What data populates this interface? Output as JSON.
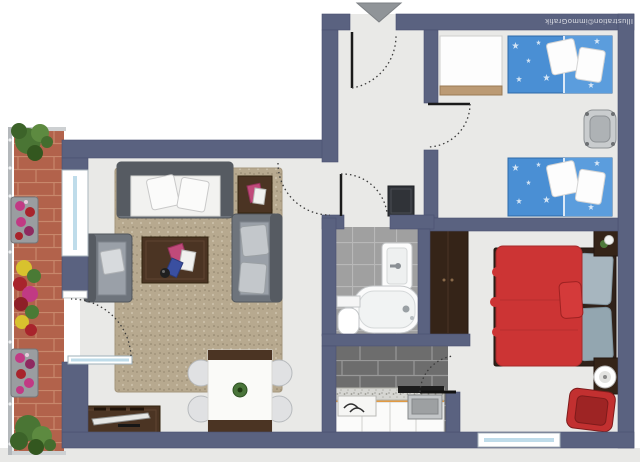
{
  "watermark": {
    "text": "Illustration©immoGrafik"
  },
  "entrance": {
    "marker": "arrow",
    "direction": "down",
    "position": "top-center"
  },
  "palette": {
    "wall": "#5a6280",
    "wall_edge": "#4a5170",
    "floor": "#e9e9e7",
    "outside": "#ffffff",
    "margin_gray": "#e8e8e6",
    "balcony_brick": "#b2624b",
    "bath_tile": "#a0a0a0",
    "kitchen_tile": "#6d6d6d",
    "rug": "#b7a98f",
    "wood_dark": "#4b3423",
    "wardrobe_wood": "#352418",
    "kids_bed_blue": "#4a8fd4",
    "kids_blanket_blue": "#5b9ddd",
    "master_bed_red": "#cc3434",
    "armchair_red": "#c23030",
    "sofa_gray": "#6e747c",
    "sofa_back_gray": "#565b62",
    "fixture_white": "#fcfcfc",
    "window_glass": "#bfdcea",
    "arrow_gray": "#909498"
  },
  "rooms": [
    {
      "id": "balcony",
      "label": "balcony",
      "items": [
        "brick tile floor",
        "railing",
        "shrub",
        "flower box",
        "flower box",
        "flower box",
        "shrub"
      ]
    },
    {
      "id": "living-room",
      "label": "living room",
      "items": [
        "three-seat sofa",
        "two-seat sofa",
        "armchair",
        "coffee table",
        "side table",
        "area rug",
        "dining table",
        "four dining chairs",
        "tv sideboard",
        "television",
        "balcony door",
        "window"
      ]
    },
    {
      "id": "hall",
      "label": "hall",
      "items": [
        "entrance door",
        "cabinet"
      ]
    },
    {
      "id": "childrens-room",
      "label": "children's room",
      "items": [
        "single bed",
        "single bed",
        "white wardrobe",
        "desk chair"
      ]
    },
    {
      "id": "bathroom",
      "label": "bathroom",
      "items": [
        "washbasin",
        "bathtub",
        "toilet"
      ]
    },
    {
      "id": "kitchen",
      "label": "kitchen",
      "items": [
        "counter with cabinets",
        "sink",
        "stove"
      ]
    },
    {
      "id": "bedroom",
      "label": "bedroom",
      "items": [
        "double bed",
        "wardrobe",
        "bedside table",
        "floor lamp",
        "red armchair",
        "window"
      ]
    }
  ]
}
